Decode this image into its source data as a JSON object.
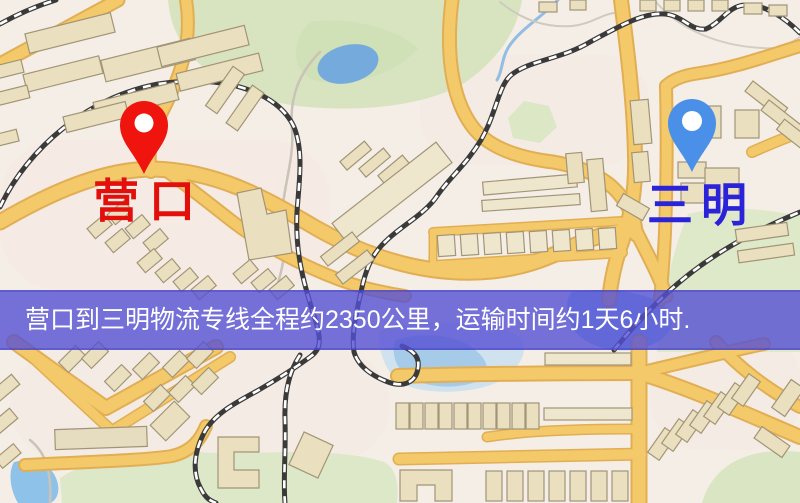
{
  "markers": {
    "origin": {
      "label": "营口",
      "text_color": "#e30f0b",
      "pin_color": "#ef150e"
    },
    "destination": {
      "label": "三明",
      "text_color": "#2b23d8",
      "pin_color": "#4a8fe8"
    }
  },
  "banner": {
    "text": "营口到三明物流专线全程约2350公里，运输时间约1天6小时.",
    "background": "rgba(85,80,211,0.8)",
    "text_color": "#ffffff"
  },
  "route_info": {
    "from": "营口",
    "to": "三明",
    "distance": "约2350公里",
    "duration": "约1天6小时"
  },
  "map_palette": {
    "background": "#f4eee6",
    "road_fill": "#f3c96a",
    "road_casing": "#e2ae54",
    "building_fill": "#eadfbe",
    "building_stroke": "#a29577",
    "park": "#d8e4c0",
    "water": "#82b3e0",
    "railway": "#3a3a3a"
  }
}
